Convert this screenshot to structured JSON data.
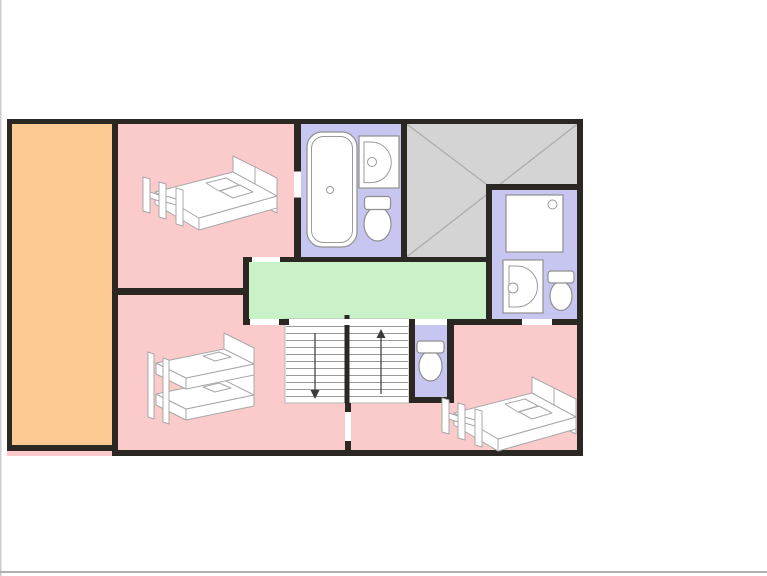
{
  "canvas": {
    "width": 767,
    "height": 576,
    "background": "#ffffff"
  },
  "palette": {
    "wall": "#2b2824",
    "bedroom": "#fbcaca",
    "side_room": "#fcca92",
    "bathroom": "#c6c6f0",
    "landing": "#c9f2c9",
    "void": "#d4d4d4",
    "void_lines": "#b0afae",
    "door_opening": "#ffffff",
    "fixture_fill": "#ffffff",
    "fixture_stroke": "#8f8f8f",
    "stair_tread": "#9a9a9a",
    "stair_arrow": "#3a3a3a",
    "furniture_stroke": "#a8a8a8",
    "edge_left": "#cccccc",
    "edge_bottom": "#b0b0b0"
  },
  "rooms": [
    {
      "id": "side-room",
      "color_key": "side_room",
      "contents": []
    },
    {
      "id": "bedroom-top-left",
      "color_key": "bedroom",
      "contents": [
        "double-bed"
      ]
    },
    {
      "id": "bathroom-main",
      "color_key": "bathroom",
      "contents": [
        "bathtub",
        "sink",
        "toilet"
      ]
    },
    {
      "id": "void-roof-space",
      "color_key": "void",
      "pattern": "corner-diagonals"
    },
    {
      "id": "ensuite-bathroom",
      "color_key": "bathroom",
      "contents": [
        "shower",
        "sink",
        "toilet"
      ]
    },
    {
      "id": "landing",
      "color_key": "landing",
      "contents": []
    },
    {
      "id": "wc",
      "color_key": "bathroom",
      "contents": [
        "toilet"
      ]
    },
    {
      "id": "bedroom-bottom-left",
      "color_key": "bedroom",
      "contents": [
        "bunk-bed"
      ]
    },
    {
      "id": "bedroom-bottom-right",
      "color_key": "bedroom",
      "contents": [
        "double-bed"
      ]
    }
  ],
  "stairs": {
    "flights": 2,
    "treads_per_flight": 11,
    "arrows": [
      "down",
      "up"
    ]
  },
  "door_openings": 6
}
